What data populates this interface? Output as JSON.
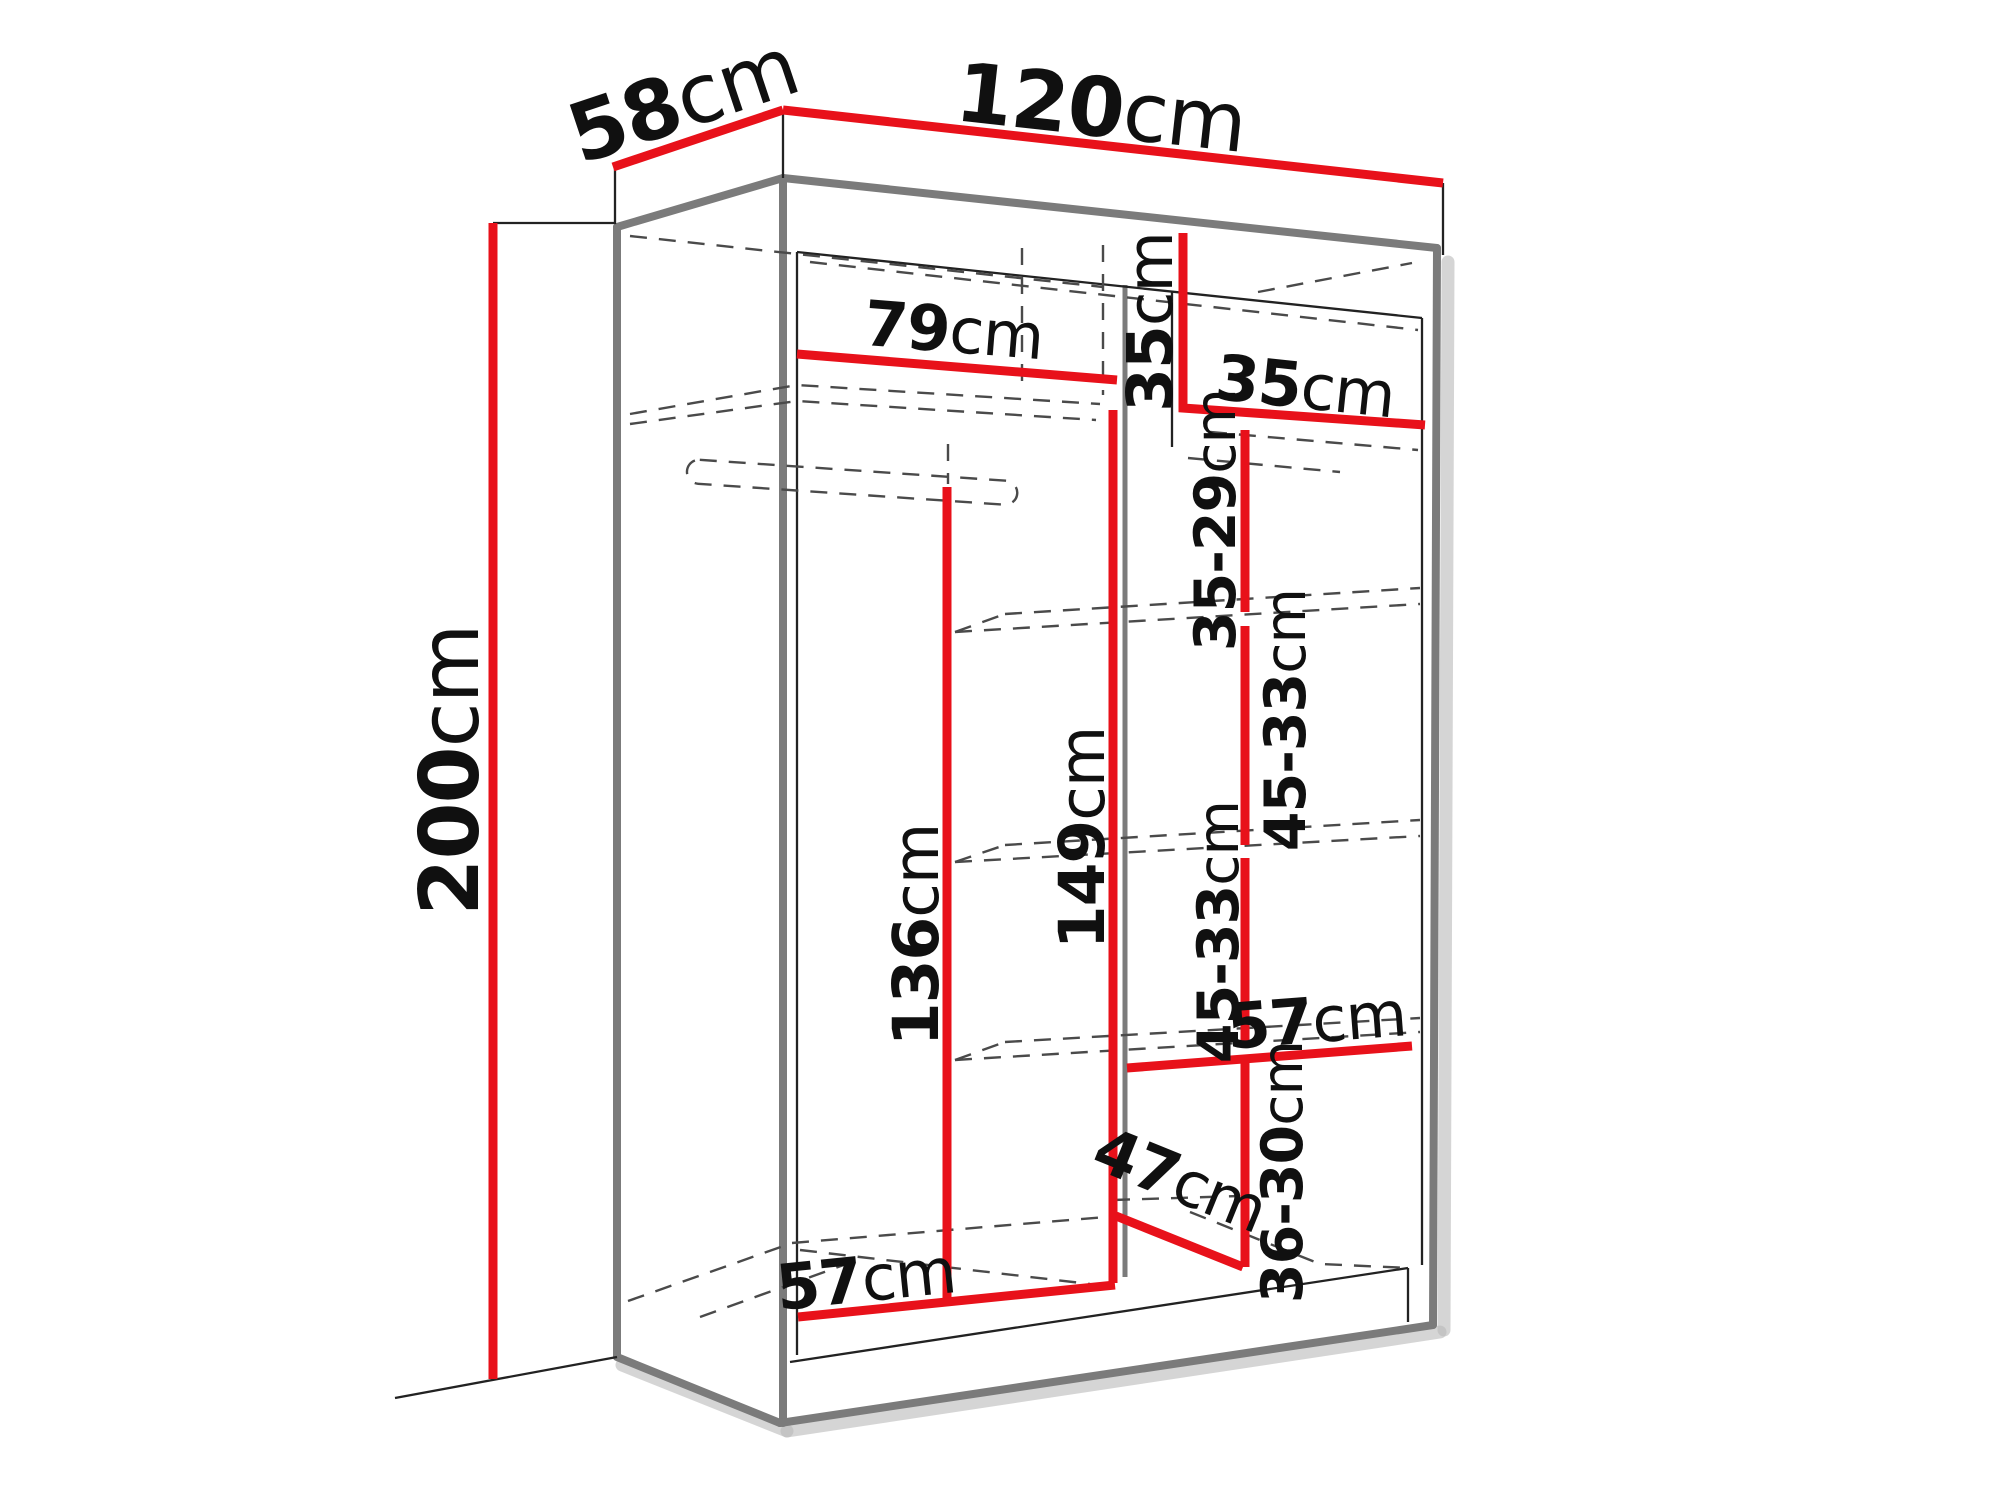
{
  "diagram": {
    "subject": "Sliding-door wardrobe interior dimensions, three-quarter perspective line drawing",
    "colors": {
      "background": "#ffffff",
      "dimension_line": "#e8111a",
      "carcass_line": "#7b7b7b",
      "outline_line": "#222222",
      "hidden_line": "#4a4a4a",
      "label_text": "#101010"
    },
    "unit": "cm",
    "labels": {
      "width": {
        "value": "120",
        "unit": "cm"
      },
      "depth": {
        "value": "58",
        "unit": "cm"
      },
      "height": {
        "value": "200",
        "unit": "cm"
      },
      "top_shelf_width": {
        "value": "79",
        "unit": "cm"
      },
      "top_cubby_height": {
        "value": "35",
        "unit": "cm"
      },
      "top_cubby_width": {
        "value": "35",
        "unit": "cm"
      },
      "shelf_gap_top": {
        "value": "35-29",
        "unit": "cm"
      },
      "shelf_gap_upper": {
        "value": "45-33",
        "unit": "cm"
      },
      "shelf_gap_lower": {
        "value": "45-33",
        "unit": "cm"
      },
      "hanging_height": {
        "value": "136",
        "unit": "cm"
      },
      "left_col_height": {
        "value": "149",
        "unit": "cm"
      },
      "shelf_width": {
        "value": "57",
        "unit": "cm"
      },
      "shelf_gap_bottom": {
        "value": "36-30",
        "unit": "cm"
      },
      "interior_depth": {
        "value": "47",
        "unit": "cm"
      },
      "interior_width": {
        "value": "57",
        "unit": "cm"
      }
    }
  }
}
